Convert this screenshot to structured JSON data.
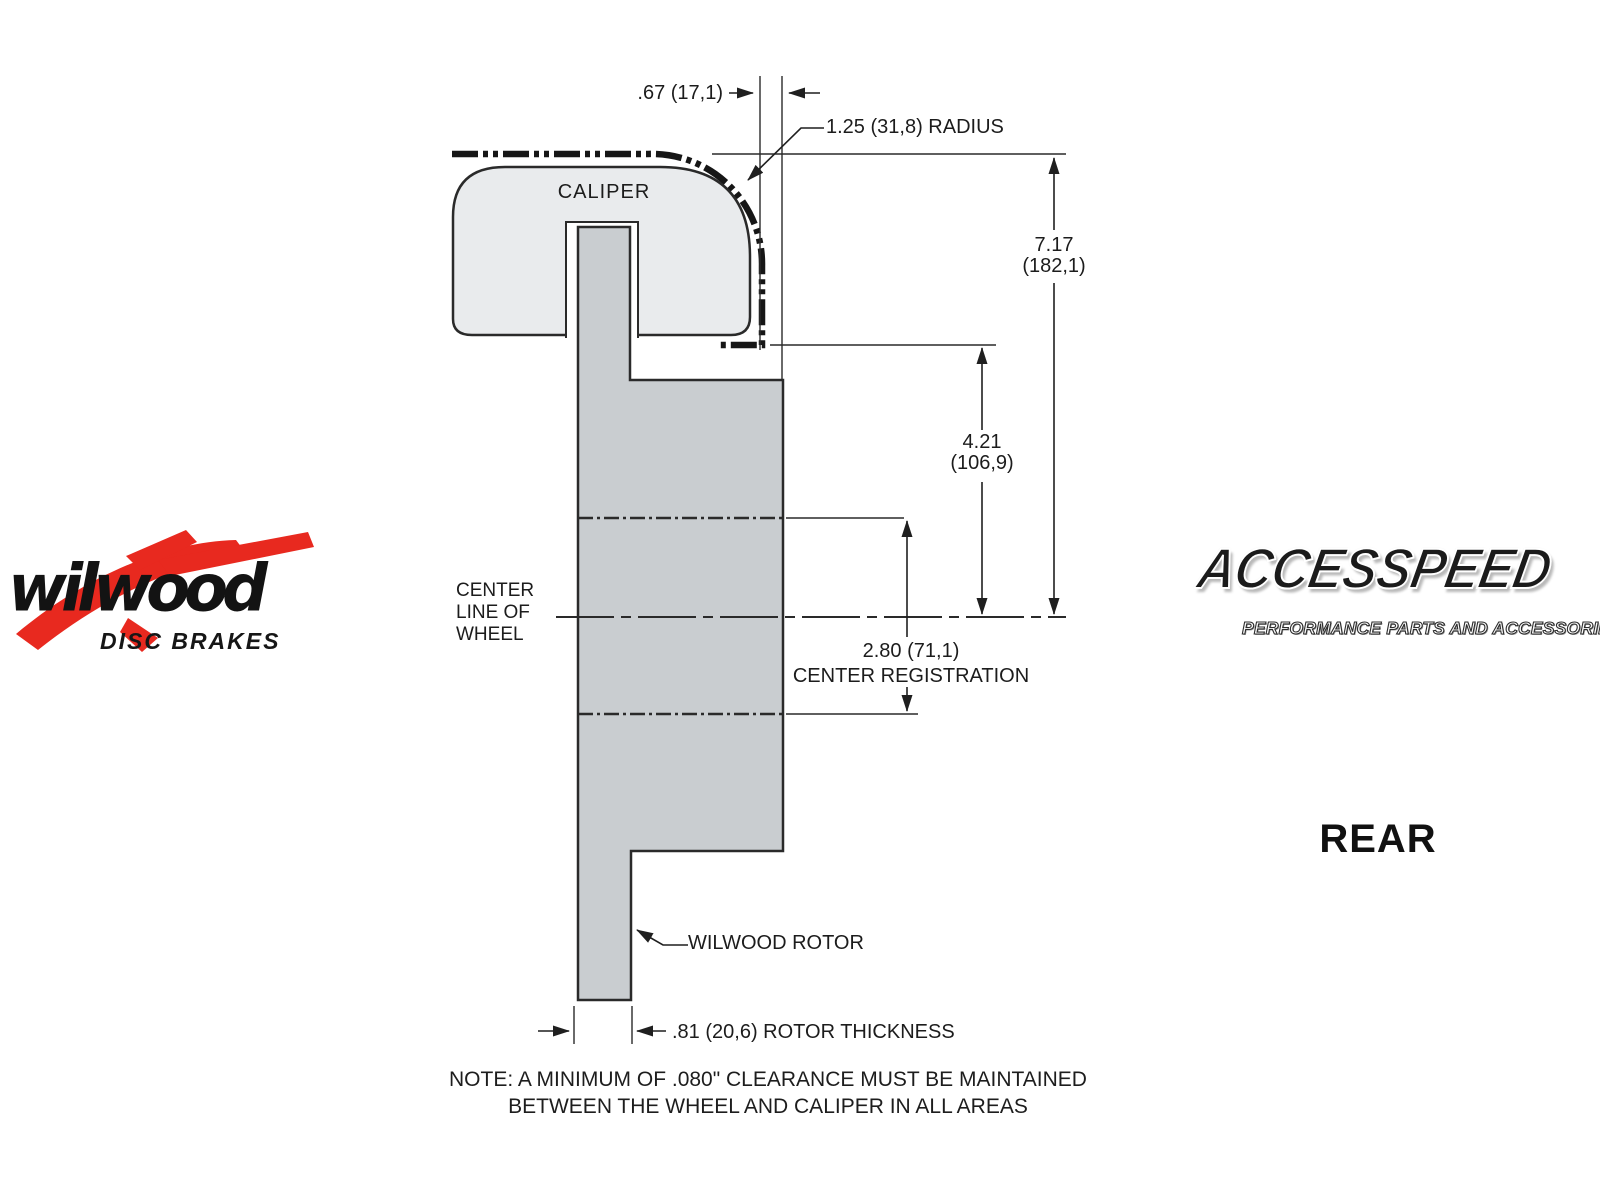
{
  "drawing": {
    "caliper_label": "CALIPER",
    "rotor_label": "WILWOOD ROTOR",
    "centerline_label_l1": "CENTER",
    "centerline_label_l2": "LINE OF",
    "centerline_label_l3": "WHEEL",
    "dim_caliper_offset": ".67 (17,1)",
    "dim_radius": "1.25 (31,8) RADIUS",
    "dim_overall_in": "7.17",
    "dim_overall_mm": "(182,1)",
    "dim_caliper_center_in": "4.21",
    "dim_caliper_center_mm": "(106,9)",
    "dim_registration_value": "2.80 (71,1)",
    "dim_registration_label": "CENTER REGISTRATION",
    "dim_rotor_thickness": ".81 (20,6) ROTOR THICKNESS",
    "view_label": "REAR",
    "note_line1": "NOTE: A MINIMUM OF .080\" CLEARANCE MUST BE MAINTAINED",
    "note_line2": "BETWEEN THE WHEEL AND CALIPER IN ALL AREAS",
    "colors": {
      "caliper_fill": "#e9ebed",
      "rotor_fill": "#c9cdd0",
      "line": "#2a2a2a"
    }
  },
  "logos": {
    "wilwood_name": "wilwood",
    "wilwood_tagline": "DISC BRAKES",
    "wilwood_red": "#e8291f",
    "accesspeed_name": "ACCESSPEED",
    "accesspeed_tagline": "PERFORMANCE PARTS AND ACCESSORIES"
  }
}
